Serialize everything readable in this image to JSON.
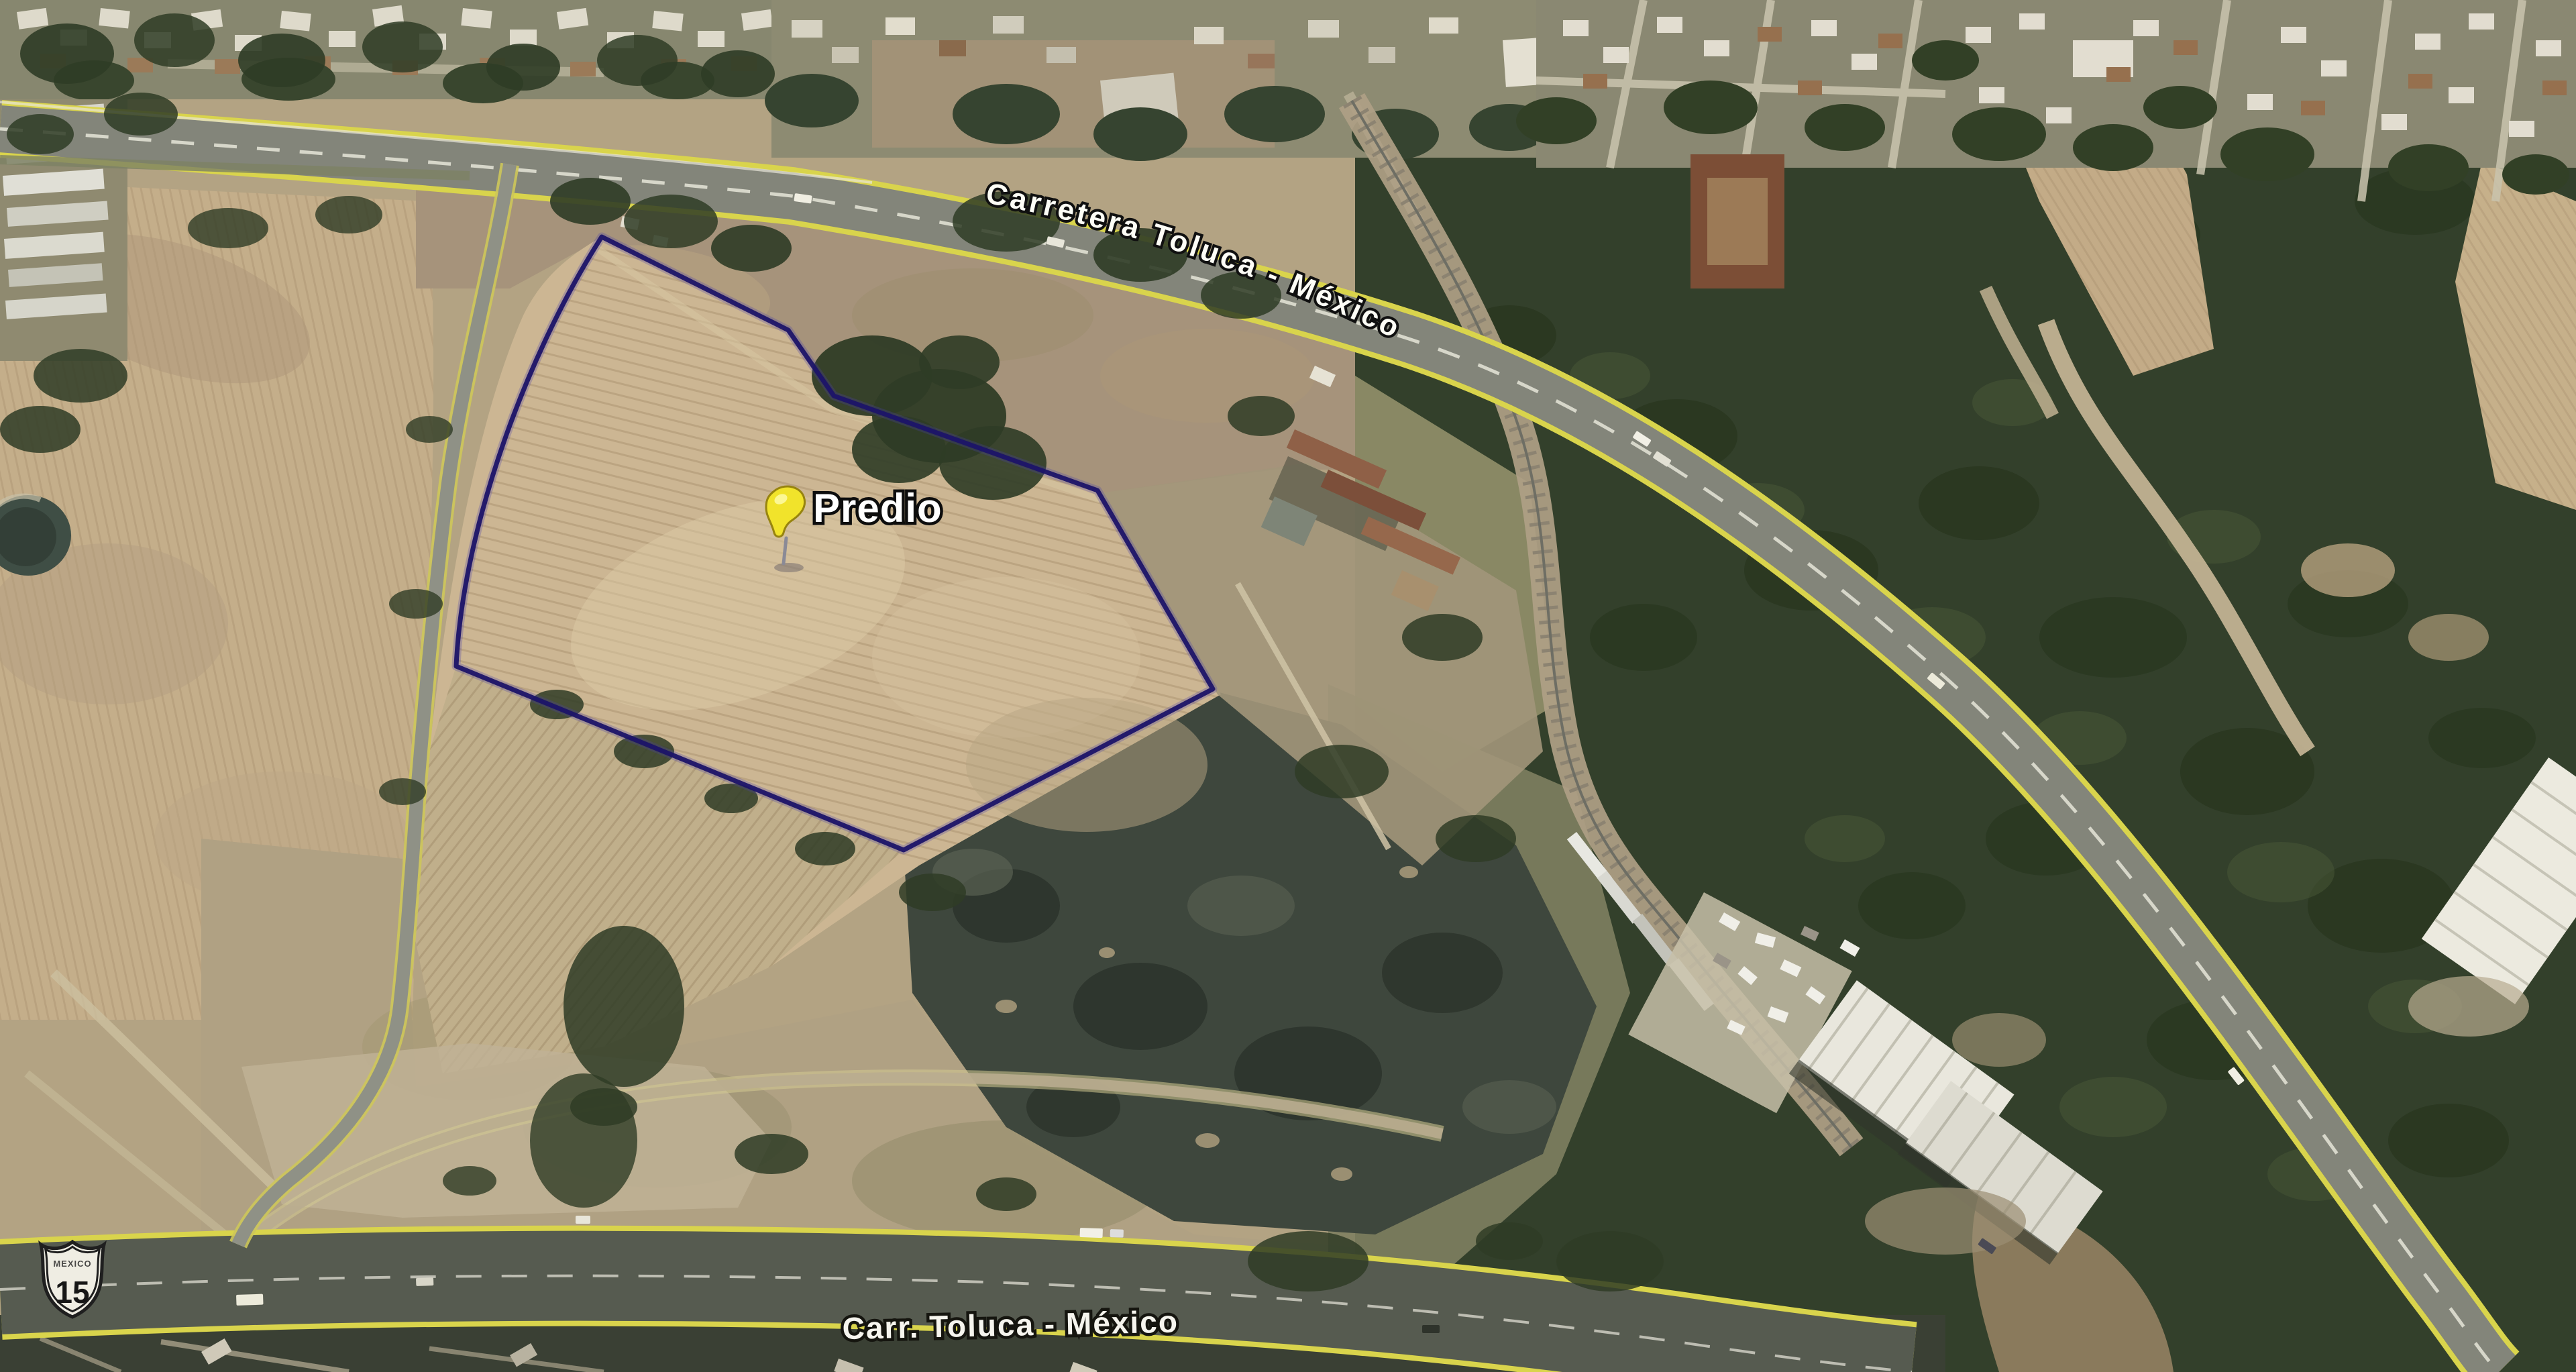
{
  "map": {
    "view_type": "satellite-aerial",
    "parcel": {
      "label": "Predio",
      "marker_icon": "pushpin-icon",
      "outline_color": "#1c1468",
      "pin_color": "#f1e32b"
    },
    "road_labels": {
      "top": "Carretera Toluca - México",
      "bottom": "Carr. Toluca - México"
    },
    "route_shield": {
      "country": "MEXICO",
      "number": "15"
    },
    "palette": {
      "field_tan": "#cbb590",
      "forest_green": "#33402b",
      "burned_dark": "#3e473d",
      "asphalt": "#83857a",
      "asphalt_dark": "#565b50",
      "road_edge_yellow": "#d9d44c",
      "rail_corridor": "#afa086",
      "warehouse_roof": "#e9e7dd"
    }
  }
}
